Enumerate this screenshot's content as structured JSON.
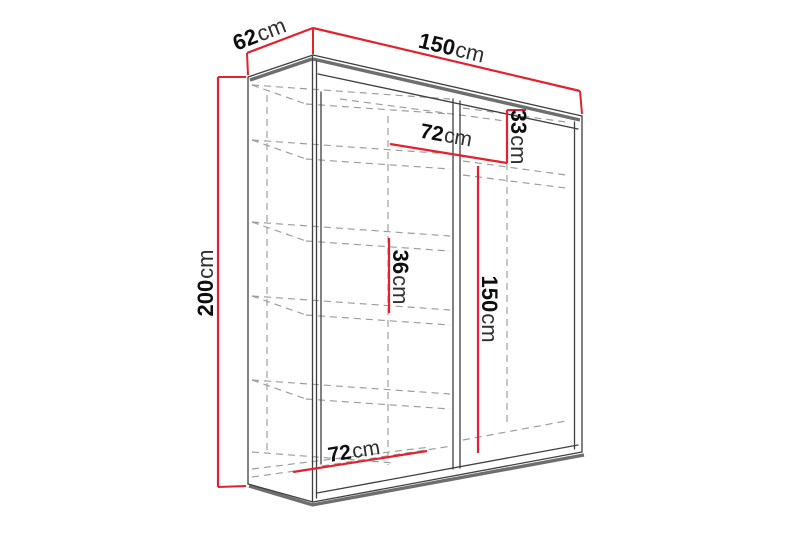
{
  "page": {
    "background_color": "#ffffff"
  },
  "colors": {
    "dimension_line_red": "#e4212d",
    "outline_dark": "#3f3f3f",
    "outline_thick_gray": "#6e6e6e",
    "hidden_line_gray": "#9b9b9b"
  },
  "diagram": {
    "type": "furniture-dimension-drawing",
    "subject": "sliding-door wardrobe with shelves, perspective line drawing",
    "dimensions": {
      "depth": {
        "value": "62",
        "unit": "cm"
      },
      "width": {
        "value": "150",
        "unit": "cm"
      },
      "height": {
        "value": "200",
        "unit": "cm"
      },
      "upper_section_width": {
        "value": "72",
        "unit": "cm"
      },
      "top_compartment_height": {
        "value": "33",
        "unit": "cm"
      },
      "shelf_spacing": {
        "value": "36",
        "unit": "cm"
      },
      "hanging_space_height": {
        "value": "150",
        "unit": "cm"
      },
      "lower_section_width": {
        "value": "72",
        "unit": "cm"
      }
    }
  }
}
